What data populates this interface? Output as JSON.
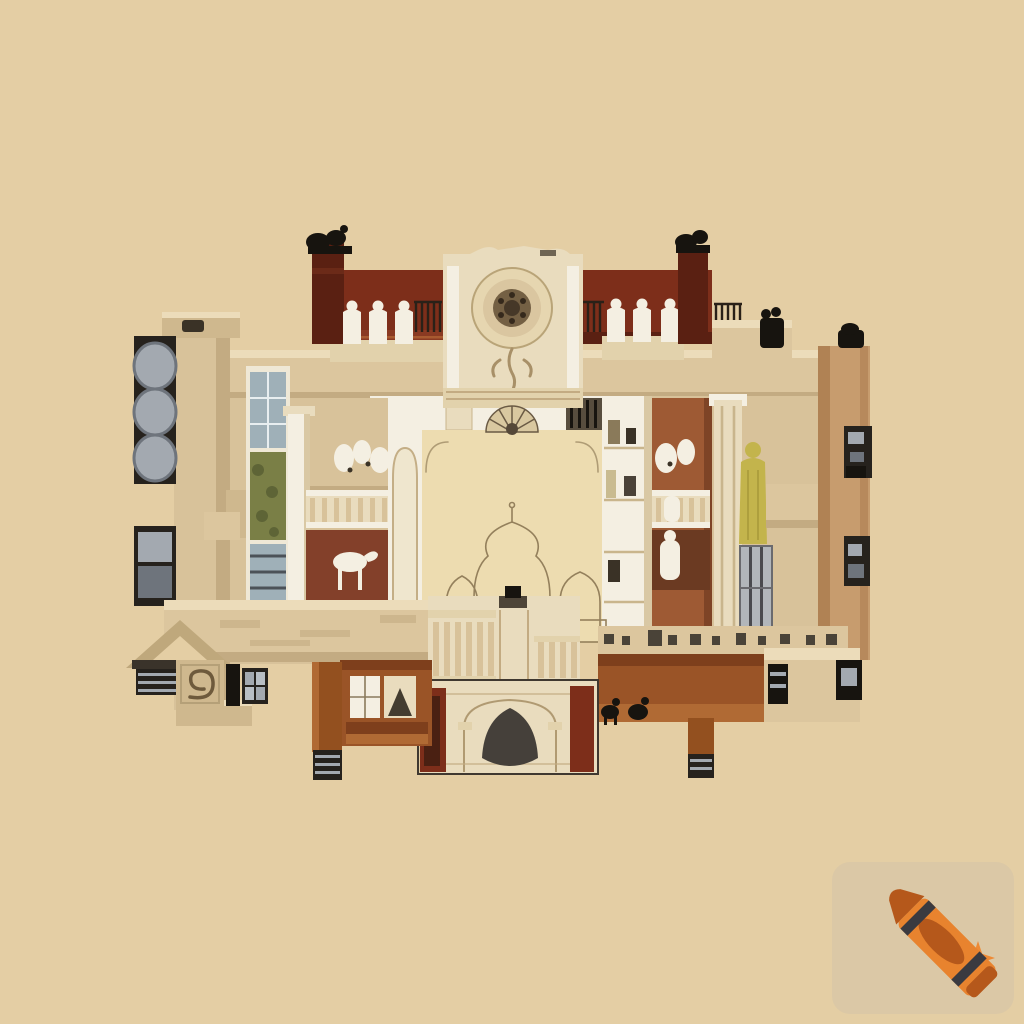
{
  "scene": {
    "aria_label": "Sepia architectural cutaway cross-section illustration of an ornate palace with courtyard, chimneys, sculptures and fireplace, on a plain beige background",
    "style": "sepia architectural cutaway illustration",
    "content_notes": {
      "upper_level": "two dark brick terrace walls with chimneys topped by black birds, small white seated figures, ornate stone facade with circular rosette medallion",
      "left_side": "stone pylon with dark alcoves holding grey barrels, gallery with balustrade and white statues, red room with white horse statue",
      "center": "open cream courtyard above a pencil-sketched onion-dome pavilion and an ornate stone fireplace with dark hearth",
      "right_side": "terracotta wall with white busts, classical column, gowned figure, silver mullioned window, tall tan wall with dark sconces",
      "bottom": "cream entablatures, terracotta beams on dark striped legs, frieze with dark dashes, gabled roof fragment and scroll panel"
    }
  },
  "palette": {
    "bg": "#e4cea4",
    "tile": "#dbc8a6",
    "brick": "#7d2e1a",
    "brick-light": "#8a3a22",
    "maroon": "#5a2012",
    "ink": "#17140f",
    "white-stone": "#f4efe2",
    "cream": "#e9dcbe",
    "cream2": "#e2d2ac",
    "tan": "#d8c29a",
    "tan2": "#cfb88e",
    "beam": "#dcc69e",
    "beam-hi": "#ecdcba",
    "beam-shadow": "#c3ab82",
    "court": "#eddcb0",
    "grey": "#a3a9b0",
    "grey-dark": "#6e747c",
    "alcove": "#26221d",
    "terracotta": "#9e5a34",
    "terra-dark": "#7e4426",
    "brown": "#9a5427",
    "brown-hi": "#b06a34",
    "brown-dark": "#7e3f1c",
    "leg-brown": "#93501f",
    "foliage": "#7a7f46",
    "foliage-dark": "#5e6436",
    "blue-grey": "#9fb0b8",
    "silver": "#b2b6ba",
    "mullion": "#4a4a4e",
    "gold": "#c3b44c",
    "hearth": "#45403a",
    "red-room": "#83402a",
    "cabinet": "#6b3a22",
    "wall-tan": "#c79c6e",
    "wall-tan-dark": "#b08254",
    "grille": "#574d3e",
    "accent-dark": "#3a3226",
    "stairs-hi": "#a85a30",
    "sketch": "#94805c",
    "frame": "#3f3830",
    "crayon": "#e8832e",
    "crayon-dark": "#b5581b",
    "crayon-stripe": "#3a3a40",
    "sparkle": "#ee8a35"
  },
  "watermark": {
    "aria_label": "Crayon watermark with sparkles",
    "icon": "crayon-icon",
    "sparkle_icon": "sparkle-icon"
  }
}
